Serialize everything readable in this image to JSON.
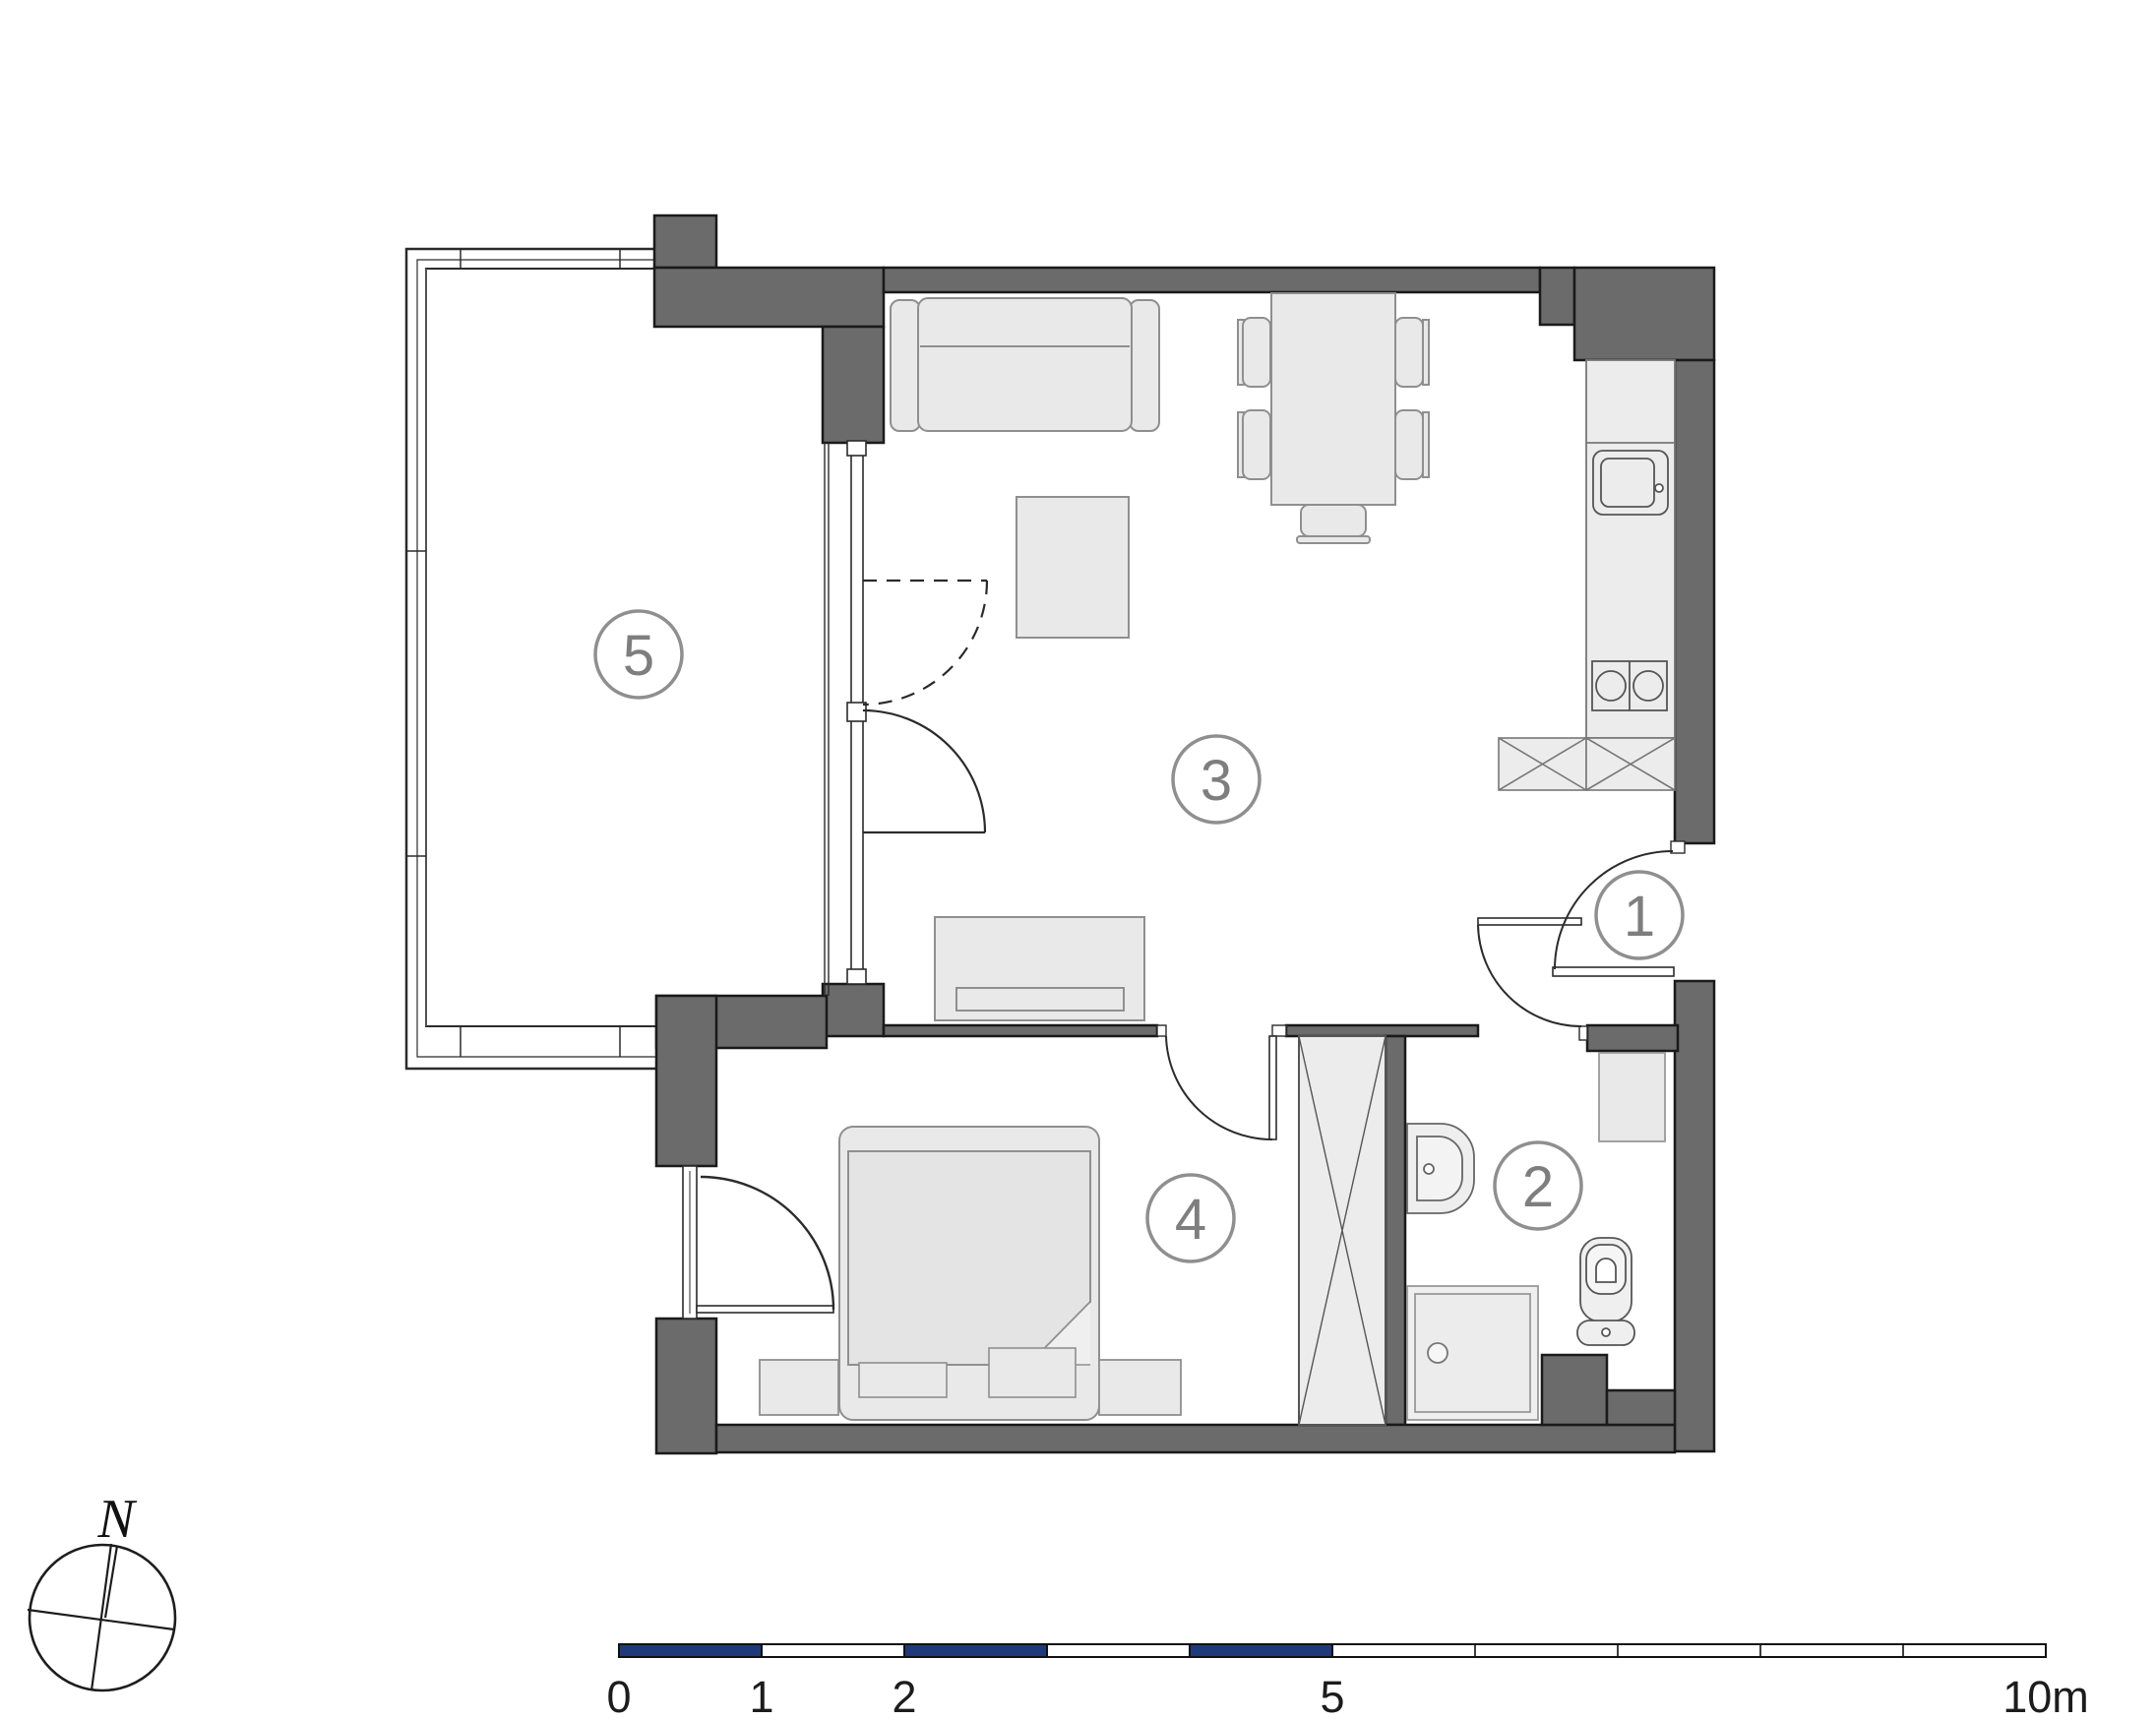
{
  "plan_title": "apartment-floor-plan",
  "rooms": [
    {
      "id": "room-1",
      "label": "1",
      "type": "entrance-hall"
    },
    {
      "id": "room-2",
      "label": "2",
      "type": "bathroom"
    },
    {
      "id": "room-3",
      "label": "3",
      "type": "living-room-kitchen"
    },
    {
      "id": "room-4",
      "label": "4",
      "type": "bedroom"
    },
    {
      "id": "room-5",
      "label": "5",
      "type": "balcony"
    }
  ],
  "compass": {
    "north_label": "N"
  },
  "scale_bar": {
    "labels": [
      "0",
      "1",
      "2",
      "5",
      "10m"
    ],
    "unit": "m",
    "total_meters": 10,
    "filled_segments_m": [
      [
        0,
        1
      ],
      [
        2,
        3
      ],
      [
        4,
        5
      ]
    ],
    "bar_color": "#1e3a7a",
    "outline_color": "#111111"
  },
  "colors": {
    "wall": "#6b6b6b",
    "wall_outline": "#1a1a1a",
    "furniture_fill": "#e9e9e9",
    "furniture_stroke": "#8f8f8f",
    "label_gray": "#7e7e7e",
    "accent_navy": "#1e3a7a"
  },
  "furniture_icons": [
    "sofa-icon",
    "coffee-table-icon",
    "dining-table-icon",
    "chair-icon",
    "kitchen-counter-icon",
    "kitchen-sink-icon",
    "cooktop-icon",
    "base-cabinet-icon",
    "tv-sideboard-icon",
    "bed-icon",
    "bench-icon",
    "wardrobe-icon",
    "washbasin-icon",
    "toilet-icon",
    "shower-icon",
    "cabinet-icon",
    "door-swing-icon",
    "sliding-window-icon",
    "north-compass-icon",
    "scale-bar-icon"
  ]
}
